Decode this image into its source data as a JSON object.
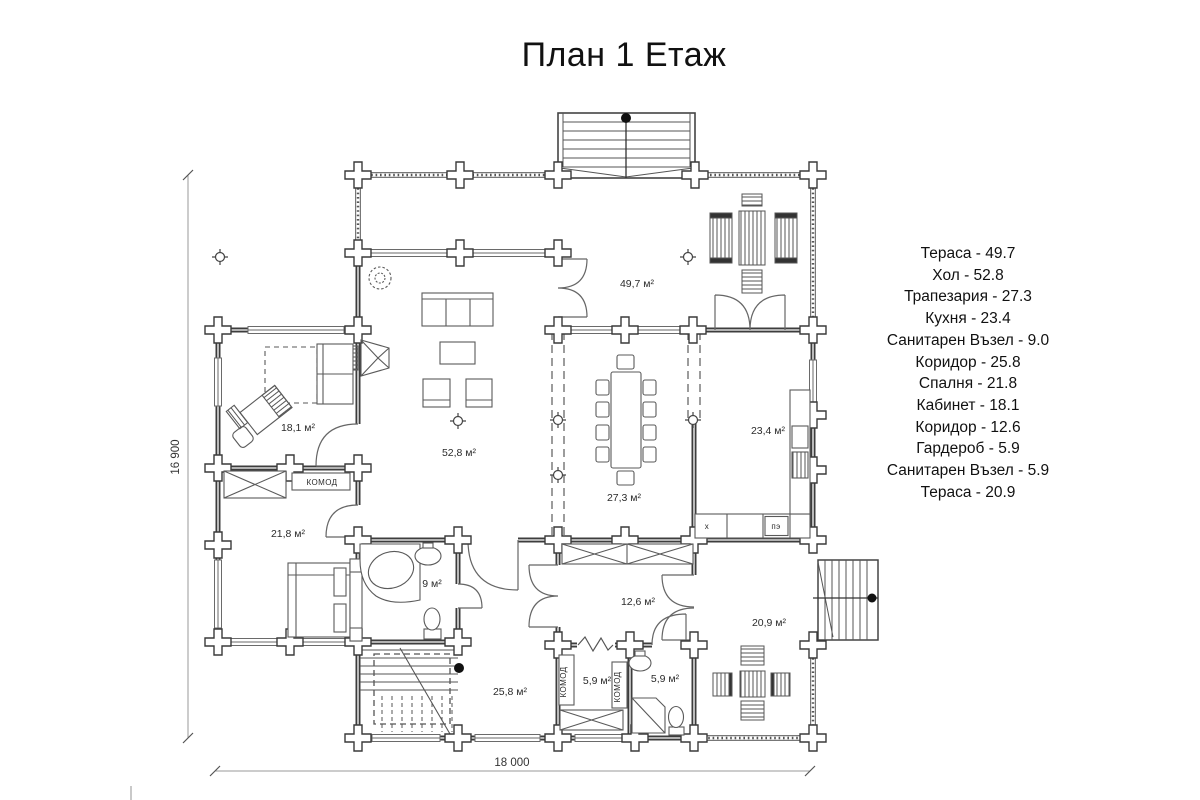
{
  "title": "План 1 Етаж",
  "legend": {
    "items": [
      "Тераса - 49.7",
      "Хол - 52.8",
      "Трапезария - 27.3",
      "Кухня - 23.4",
      "Санитарен Възел - 9.0",
      "Коридор - 25.8",
      "Спалня - 21.8",
      "Кабинет - 18.1",
      "Коридор - 12.6",
      "Гардероб - 5.9",
      "Санитарен Възел - 5.9",
      "Тераса - 20.9"
    ]
  },
  "plan": {
    "rooms": [
      {
        "id": "terrace-top",
        "area": "49,7 м²"
      },
      {
        "id": "hall",
        "area": "52,8 м²"
      },
      {
        "id": "dining",
        "area": "27,3 м²"
      },
      {
        "id": "kitchen",
        "area": "23,4 м²"
      },
      {
        "id": "cabinet",
        "area": "18,1 м²"
      },
      {
        "id": "bedroom",
        "area": "21,8 м²"
      },
      {
        "id": "bathroom",
        "area": "9 м²"
      },
      {
        "id": "corridor-main",
        "area": "25,8 м²"
      },
      {
        "id": "corridor-small",
        "area": "12,6 м²"
      },
      {
        "id": "closet",
        "area": "5,9 м²"
      },
      {
        "id": "wc",
        "area": "5,9 м²"
      },
      {
        "id": "terrace-bottom",
        "area": "20,9 м²"
      }
    ],
    "labels": {
      "komod_bedroom": "КОМОД",
      "komod_closet_left": "КОМОД",
      "komod_closet_right": "КОМОД",
      "kitchen_unit_left": "х",
      "kitchen_unit_right": "пэ"
    },
    "dimensions": {
      "width": "18 000",
      "height": "16 900"
    }
  }
}
